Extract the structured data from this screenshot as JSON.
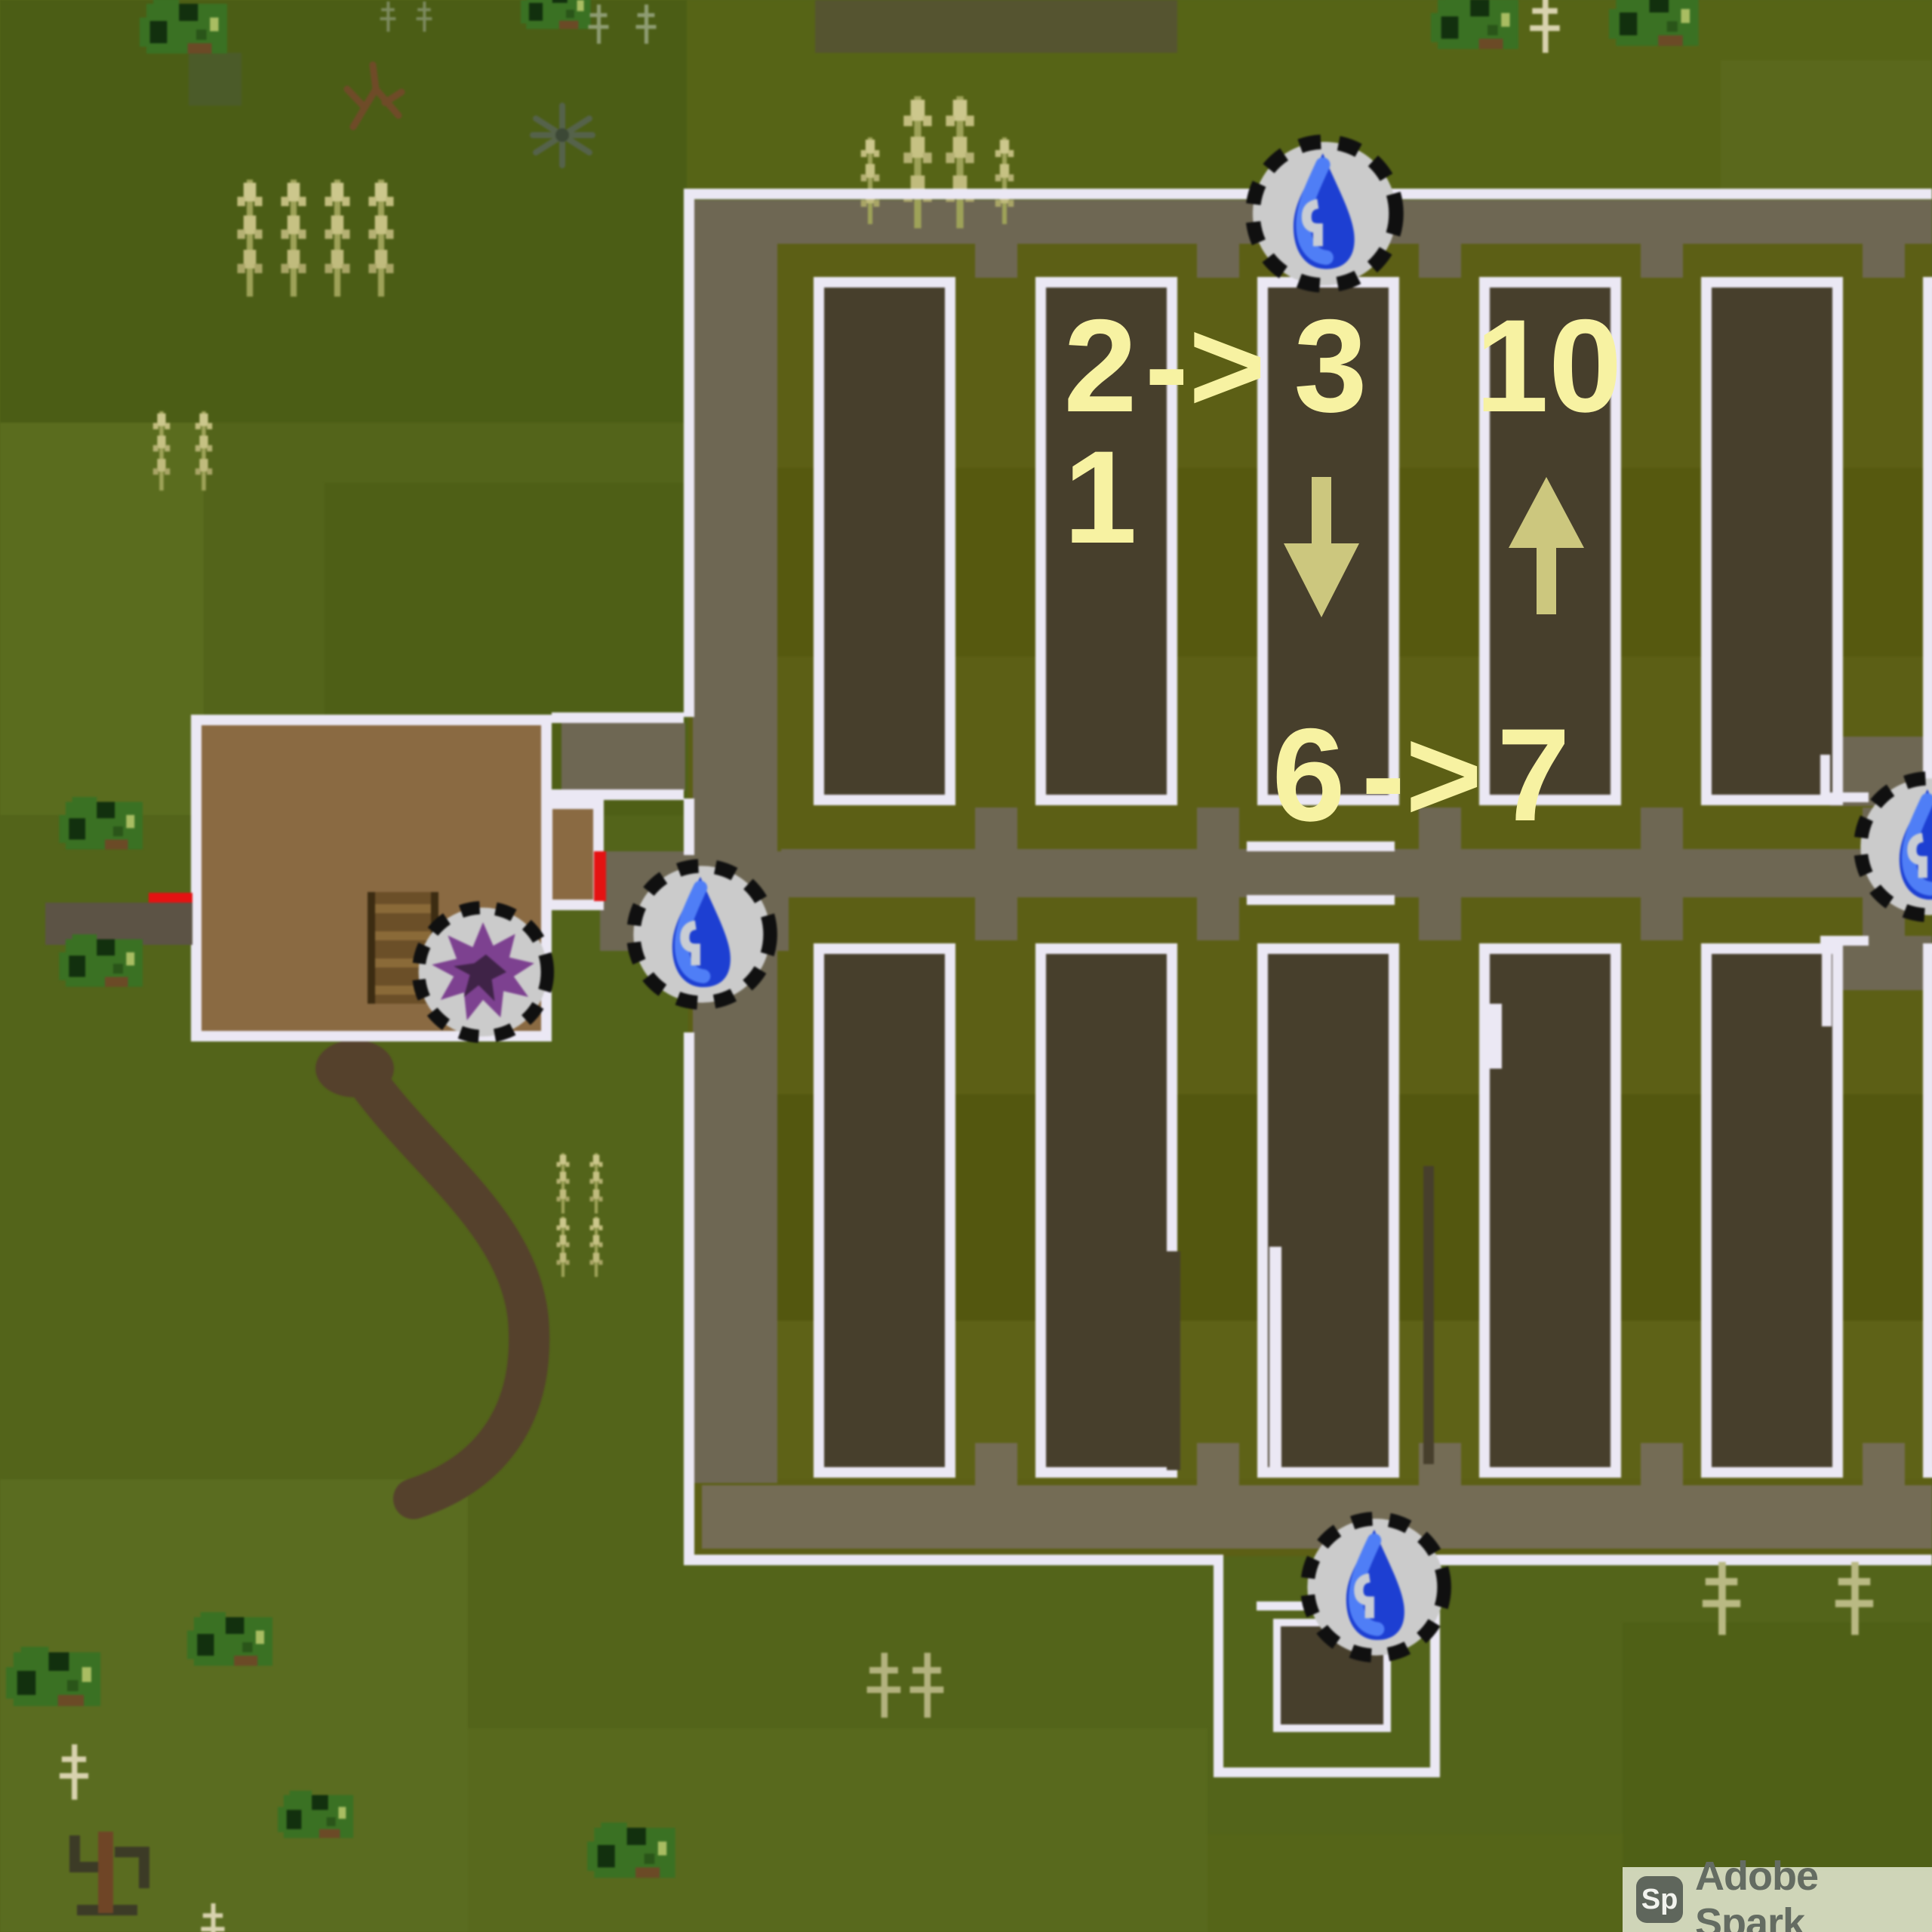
{
  "map": {
    "description": "pixel-art game world map of a farm with vine plots, annotated with numbered route labels",
    "annotations": {
      "plot2_top": "2",
      "plot2_bottom": "1",
      "route1_arrow": "->",
      "plot3_label": "3",
      "plot4_label": "10",
      "route2_from": "6",
      "route2_arrow": "->",
      "route2_to": "7",
      "direction_down": "down-arrow",
      "direction_up": "up-arrow"
    },
    "icons": {
      "water_source": {
        "name": "water-source-icon",
        "count": 4
      },
      "grapes": {
        "name": "grapes-icon",
        "count": 1
      }
    },
    "colors": {
      "grass": "#53641a",
      "farm_ground": "#5c5f15",
      "road": "#6e6753",
      "plot": "#473f2c",
      "fence": "#ebe8f4",
      "building": "#8a6a42",
      "door": "#e41212",
      "annotation_text": "#f7f2a2",
      "annotation_arrow": "#ccc77e",
      "water_icon_blue": "#1d3fd2",
      "grapes_purple": "#7d4190"
    }
  },
  "watermark": {
    "logo": "Sp",
    "label": "Adobe Spark"
  }
}
